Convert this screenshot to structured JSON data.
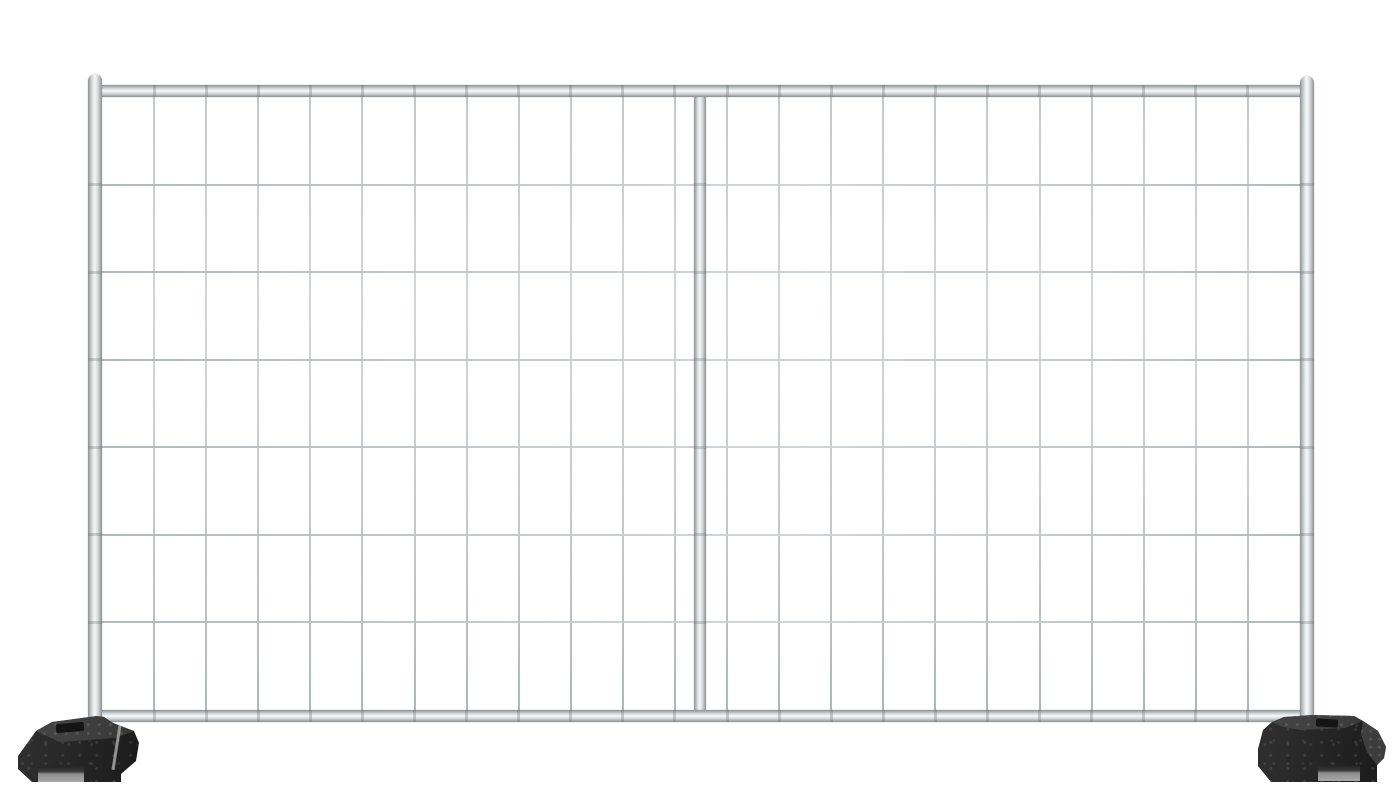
{
  "meta": {
    "title": "Temporary fence panel product photo",
    "background_color": "#ffffff"
  },
  "fence": {
    "description": "Galvanized steel temporary fencing panel with welded wire mesh, two outer round-tube uprights, one center upright, top and bottom rails, standing in two black recycled-rubber base blocks",
    "frame": {
      "tube_mid_color": "#f4f5f6",
      "tube_edge_color": "#8d9194",
      "uprights": 3,
      "rails": 2
    },
    "mesh": {
      "wire_color": "#c2c6c9",
      "columns": 23,
      "rows": 7
    }
  },
  "feet": {
    "count": 2,
    "front_color": "#242424",
    "top_color": "#3e3e3e",
    "slot_color": "#8f8f8f",
    "items": [
      {
        "side": "left"
      },
      {
        "side": "right"
      }
    ]
  }
}
